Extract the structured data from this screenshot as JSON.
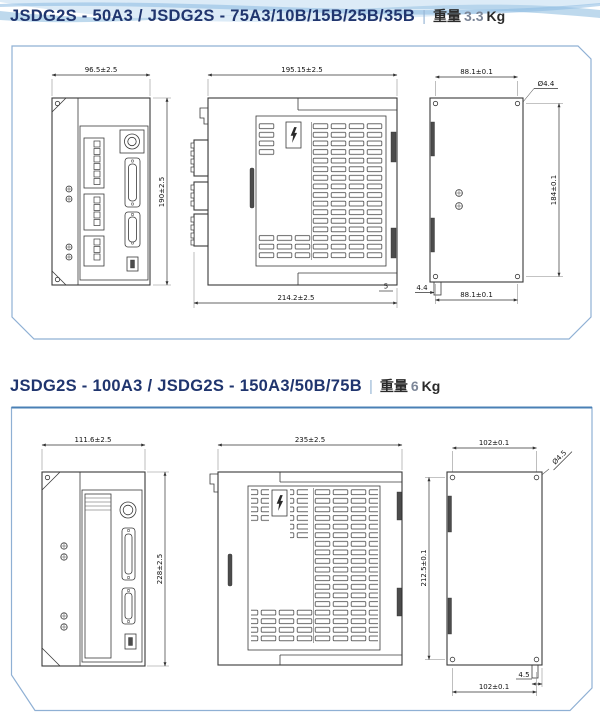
{
  "colors": {
    "accent_navy": "#20356e",
    "panel_border": "#8fb0d4",
    "wave_blue": "#aecfe9"
  },
  "sections": [
    {
      "title": "JSDG2S - 50A3 / JSDG2S - 75A3/10B/15B/25B/35B",
      "separator": "|",
      "weight_label": "重量",
      "weight_value": "3.3",
      "weight_unit": "Kg",
      "front": {
        "width": "96.5±2.5",
        "height": "190±2.5"
      },
      "side": {
        "width_top": "195.15±2.5",
        "width_bottom": "214.2±2.5",
        "edge_offset": "5"
      },
      "back": {
        "width_top": "88.1±0.1",
        "height": "184±0.1",
        "width_bottom": "88.1±0.1",
        "hole_diameter": "Ø4.4",
        "tab_offset": "4.4"
      }
    },
    {
      "title": "JSDG2S - 100A3 / JSDG2S - 150A3/50B/75B",
      "separator": "|",
      "weight_label": "重量",
      "weight_value": "6",
      "weight_unit": "Kg",
      "front": {
        "width": "111.6±2.5",
        "height": "228±2.5"
      },
      "side": {
        "width_top": "235±2.5"
      },
      "back": {
        "width_top": "102±0.1",
        "height": "212.5±0.1",
        "width_bottom": "102±0.1",
        "hole_diameter": "Ø4.5",
        "tab_offset": "4.5"
      }
    }
  ]
}
